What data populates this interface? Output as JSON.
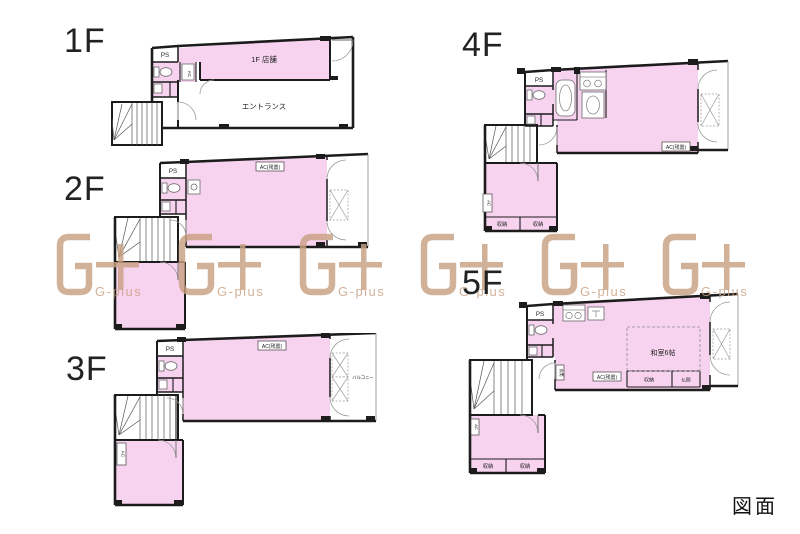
{
  "caption": "図面",
  "watermark": {
    "text": "G-plus",
    "color": "#c9a183"
  },
  "colors": {
    "room_fill": "#f7d3ef",
    "wall": "#1c1c1c"
  },
  "floors": {
    "f1": {
      "label": "1F",
      "ps": "PS",
      "ac": "AC",
      "shop": "1F 店舗",
      "entrance": "エントランス"
    },
    "f2": {
      "label": "2F",
      "ps": "PS",
      "ac_note": "AC(残置)"
    },
    "f3": {
      "label": "3F",
      "ps": "PS",
      "ac_note": "AC(残置)",
      "balcony": "バルコニー",
      "ac": "AC"
    },
    "f4": {
      "label": "4F",
      "ps": "PS",
      "ac_note": "AC(残置)",
      "ac": "AC",
      "storage_left": "収納",
      "storage_right": "収納"
    },
    "f5": {
      "label": "5F",
      "ps": "PS",
      "ac_note": "AC(残置)",
      "washitsu": "和室6帖",
      "storage": "収納",
      "butsuma": "仏間",
      "genkan": "玄関",
      "ac": "AC",
      "storage_left": "収納",
      "storage_right": "収納"
    }
  }
}
